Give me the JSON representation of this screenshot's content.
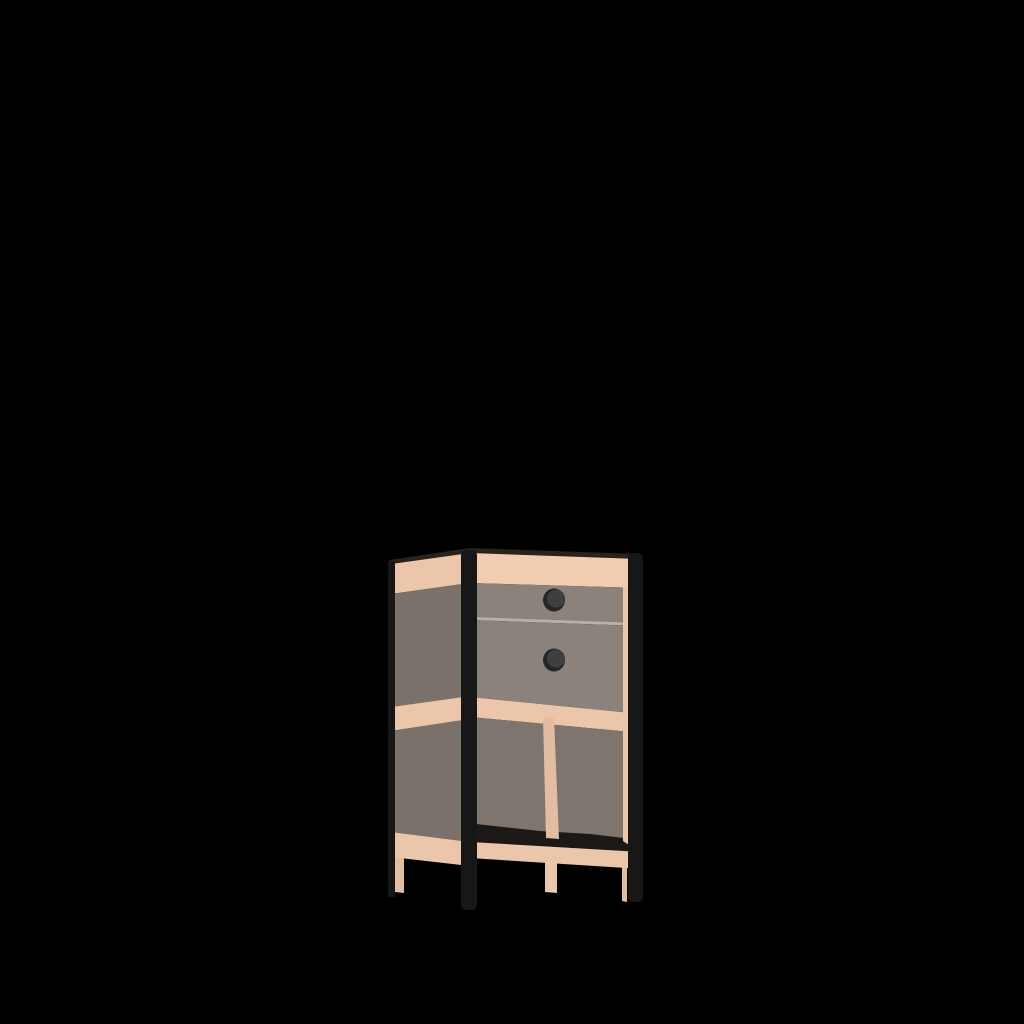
{
  "scene": {
    "description": "3D render of a small two-drawer nightstand with an open lower shelf, light wood frame and rails, gray-brown panels, black metal corner legs, shown in three-quarter front-left view on a black background",
    "background_color": "#000000",
    "canvas": {
      "width": 1024,
      "height": 1024
    },
    "object": {
      "name": "nightstand",
      "drawer_count": 2,
      "knob_count": 2,
      "open_shelf": true,
      "shelf_divider": true,
      "material_wood": "light wood",
      "material_panels": "gray-brown",
      "material_legs": "black metal"
    },
    "palette": {
      "background": "#000000",
      "wood_light": "#f1ccb1",
      "wood_mid": "#ecc6aa",
      "wood_dark": "#e2bda1",
      "gray_front": "#8b827b",
      "gray_side": "#7a716b",
      "gray_interior": "#7e756e",
      "metal_black": "#171717",
      "knob_dark": "#262626",
      "knob_face": "#3f3f3f",
      "floor_shadow": "#1b1815",
      "divider_highlight": "#b8b1a9",
      "top_edge_shadow": "#2b221b"
    },
    "parts": [
      {
        "name": "top-edge",
        "shape": "polygon",
        "points": "389,560 470,548 641,554 641,559 470,553 389,564",
        "color": "top_edge_shadow"
      },
      {
        "name": "side-top-band",
        "shape": "polygon",
        "points": "391,564 470,553 470,583 391,594",
        "color": "wood_mid"
      },
      {
        "name": "side-panel-upper",
        "shape": "polygon",
        "points": "391,594 470,583 470,696 391,707",
        "color": "gray_side"
      },
      {
        "name": "side-mid-band",
        "shape": "polygon",
        "points": "391,707 470,696 470,719 391,731",
        "color": "wood_mid"
      },
      {
        "name": "side-panel-lower",
        "shape": "polygon",
        "points": "391,731 470,719 470,842 391,832",
        "color": "gray_side"
      },
      {
        "name": "side-bottom-band",
        "shape": "polygon",
        "points": "391,832 470,842 470,866 391,857",
        "color": "wood_mid"
      },
      {
        "name": "side-back-wood-leg",
        "shape": "polygon",
        "points": "395,857 404,858 404,893 395,892",
        "color": "wood_dark"
      },
      {
        "name": "front-top-rail",
        "shape": "polygon",
        "points": "470,553 641,559 641,588 470,583",
        "color": "wood_light"
      },
      {
        "name": "upper-drawer-front",
        "shape": "polygon",
        "points": "470,583 641,588 641,624 470,618",
        "color": "gray_front"
      },
      {
        "name": "drawer-gap-line",
        "shape": "polygon",
        "points": "470,617 641,623 641,626 470,620",
        "color": "divider_highlight"
      },
      {
        "name": "lower-drawer-front",
        "shape": "polygon",
        "points": "470,620 641,626 641,714 470,697",
        "color": "gray_front"
      },
      {
        "name": "shelf-front-rail",
        "shape": "polygon",
        "points": "470,697 641,714 641,733 470,717",
        "color": "wood_mid"
      },
      {
        "name": "shelf-back-panel",
        "shape": "polygon",
        "points": "470,717 641,733 641,853 470,842",
        "color": "gray_interior"
      },
      {
        "name": "shelf-floor",
        "shape": "polygon",
        "points": "476,824 540,831 590,834 624,838 641,852 470,842",
        "color": "floor_shadow"
      },
      {
        "name": "shelf-divider",
        "shape": "polygon",
        "points": "543,717 554,718 559,839 546,838",
        "color": "wood_dark"
      },
      {
        "name": "front-right-stile",
        "shape": "polygon",
        "points": "623,587 641,590 641,853 623,841",
        "color": "wood_mid"
      },
      {
        "name": "back-right-wood-leg",
        "shape": "polygon",
        "points": "622,856 627,857 627,902 622,901",
        "color": "wood_dark"
      },
      {
        "name": "bottom-front-rail",
        "shape": "polygon",
        "points": "470,842 641,852 641,869 470,858",
        "color": "wood_mid"
      },
      {
        "name": "front-middle-wood-leg",
        "shape": "polygon",
        "points": "545,862 557,863 557,893 545,892",
        "color": "wood_mid"
      },
      {
        "name": "back-left-metal-leg",
        "shape": "rect",
        "x": 388,
        "y": 561,
        "w": 7,
        "h": 336,
        "rx": 2,
        "color": "metal_black"
      },
      {
        "name": "front-left-metal-leg",
        "shape": "rect",
        "x": 461,
        "y": 550,
        "w": 16,
        "h": 360,
        "rx": 5,
        "color": "metal_black"
      },
      {
        "name": "front-right-metal-leg",
        "shape": "rect",
        "x": 628,
        "y": 553,
        "w": 15,
        "h": 349,
        "rx": 5,
        "color": "metal_black"
      },
      {
        "name": "upper-drawer-knob-base",
        "shape": "ellipse",
        "cx": 554,
        "cy": 600,
        "rx": 11,
        "ry": 11.5,
        "color": "knob_dark"
      },
      {
        "name": "upper-drawer-knob-face",
        "shape": "ellipse",
        "cx": 556,
        "cy": 598.5,
        "rx": 9,
        "ry": 9,
        "color": "knob_face"
      },
      {
        "name": "lower-drawer-knob-base",
        "shape": "ellipse",
        "cx": 554,
        "cy": 660,
        "rx": 11,
        "ry": 11.5,
        "color": "knob_dark"
      },
      {
        "name": "lower-drawer-knob-face",
        "shape": "ellipse",
        "cx": 556,
        "cy": 658.5,
        "rx": 9,
        "ry": 9,
        "color": "knob_face"
      }
    ]
  }
}
